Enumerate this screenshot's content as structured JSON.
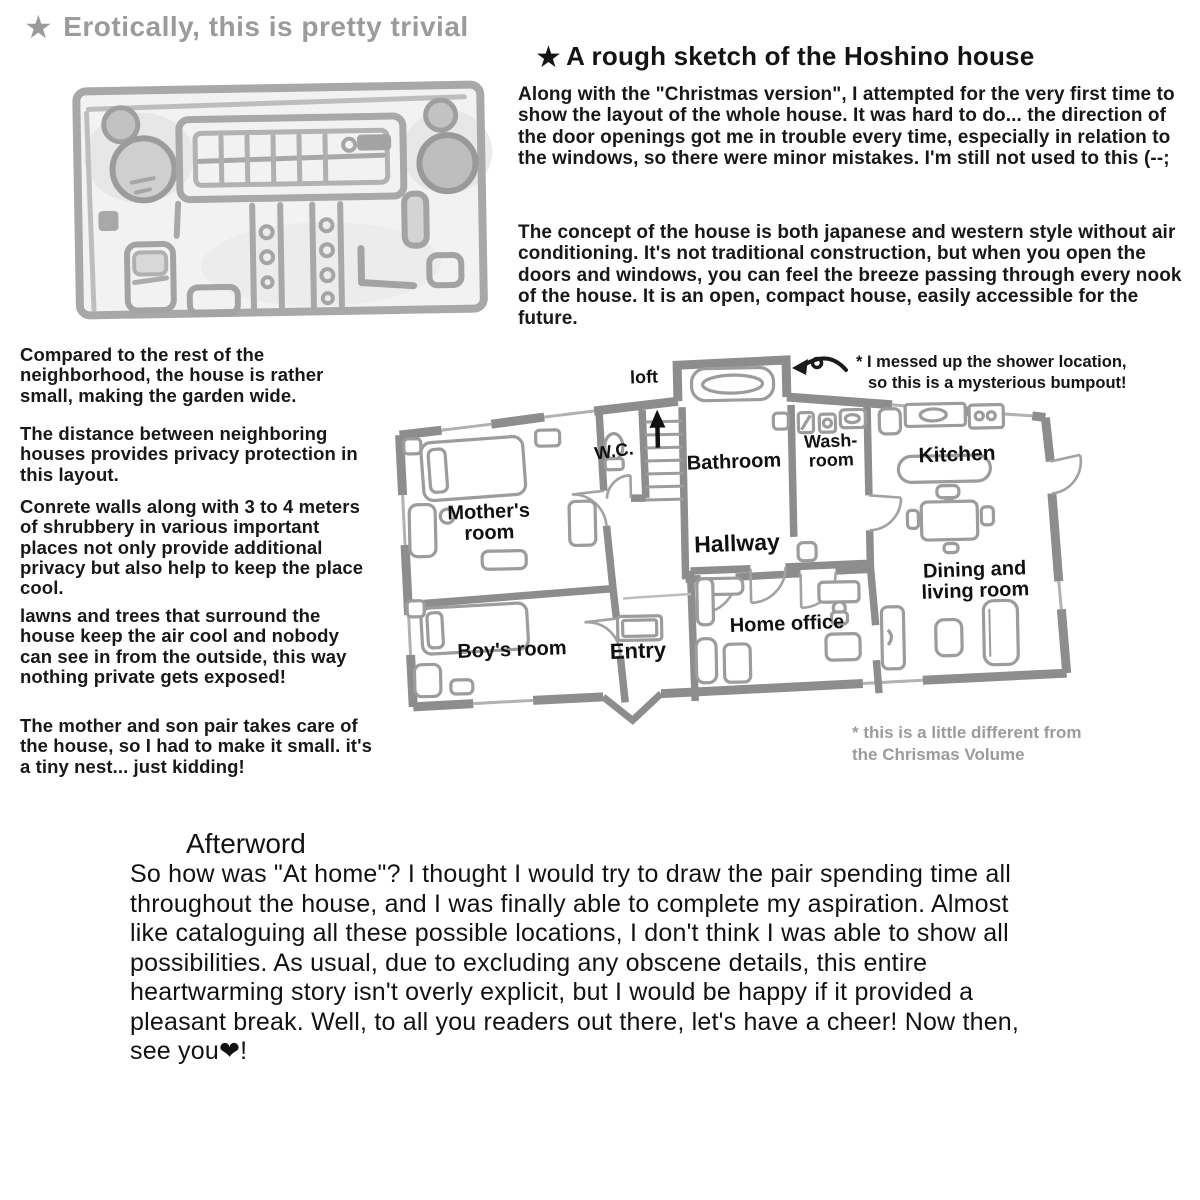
{
  "colors": {
    "ink": "#161616",
    "gray_text": "#9b9b9b",
    "wall_gray": "#8d8d8d",
    "furniture_gray": "#9c9c9c",
    "sketch_gray": "#b0b0b0"
  },
  "top_left": {
    "star_icon": "★",
    "caption": "Erotically, this is pretty trivial"
  },
  "top_right": {
    "star_icon": "★",
    "heading": "A rough sketch of the Hoshino house",
    "paragraphs": [
      "Along with the \"Christmas version\", I attempted for the very first time to show the layout of the whole house. It was hard to do... the direction of the door openings got me in trouble every time, especially in relation to the windows, so there were minor mistakes. I'm still not used to this (--;",
      "The concept of the house is both japanese and western style without air conditioning. It's not traditional construction, but when you open the doors and windows, you can feel the breeze passing through every nook of the house. It is an open, compact house, easily accessible for the future."
    ]
  },
  "left_column": {
    "paragraphs": [
      "Compared to the rest of the neighborhood, the house is rather small, making the garden wide.",
      "The distance between neighboring houses provides privacy protection in this layout.",
      "Conrete walls along with 3 to 4 meters of shrubbery in various important places not only provide additional privacy but also help to keep the place cool.",
      "lawns and trees that surround the house keep the air cool and nobody can see in from the outside, this way nothing private gets exposed!",
      "The mother and son pair takes care of the house, so I had to make it small. it's a tiny nest... just kidding!"
    ]
  },
  "floor_plan": {
    "shower_note_line1": "* I messed up the shower location,",
    "shower_note_line2": "so this is a mysterious bumpout!",
    "rooms": {
      "loft": "loft",
      "wc": "W.C.",
      "bathroom": "Bathroom",
      "washroom_line1": "Wash-",
      "washroom_line2": "room",
      "kitchen": "Kitchen",
      "mothers_room_line1": "Mother's",
      "mothers_room_line2": "room",
      "hallway": "Hallway",
      "dining_line1": "Dining and",
      "dining_line2": "living room",
      "boys_room": "Boy's room",
      "entry": "Entry",
      "home_office": "Home office"
    },
    "footnote_line1": "* this is a little different from",
    "footnote_line2": "the Chrismas Volume"
  },
  "afterword": {
    "heading": "Afterword",
    "body": "So how was \"At home\"? I thought I would try to draw the pair spending time all throughout the house, and I was finally able to complete my aspiration. Almost like cataloguing all these possible locations, I don't think I was able to show all possibilities. As usual, due to excluding any obscene details, this entire heartwarming story isn't overly explicit, but I would be happy if it provided a pleasant break. Well, to all you readers out there, let's have a cheer! Now then, see you❤!"
  }
}
